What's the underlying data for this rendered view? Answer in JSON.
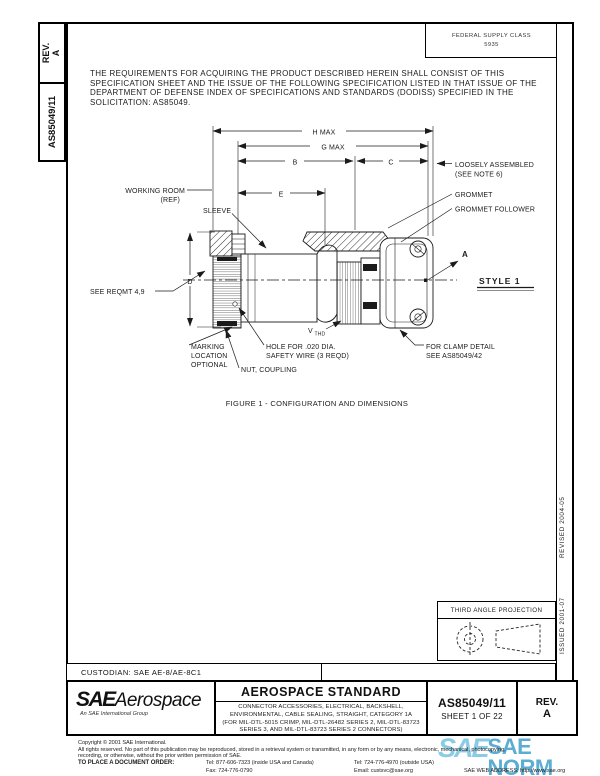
{
  "header": {
    "fsc_line1": "FEDERAL SUPPLY CLASS",
    "fsc_line2": "5935"
  },
  "sidebar": {
    "rev_label": "REV.",
    "rev_value": "A",
    "doc": "AS85049/11"
  },
  "right_margin": {
    "issued": "ISSUED 2001-07",
    "revised": "REVISED 2004-05"
  },
  "intro": {
    "lines": [
      "THE REQUIREMENTS FOR ACQUIRING THE PRODUCT DESCRIBED HEREIN SHALL CONSIST OF THIS",
      "SPECIFICATION SHEET AND THE ISSUE OF THE FOLLOWING SPECIFICATION LISTED IN THAT ISSUE OF THE",
      "DEPARTMENT OF DEFENSE INDEX OF SPECIFICATIONS AND STANDARDS (DODISS) SPECIFIED IN THE",
      "SOLICITATION: AS85049."
    ]
  },
  "figure": {
    "caption": "FIGURE 1 - CONFIGURATION AND DIMENSIONS",
    "dims": {
      "h": "H MAX",
      "g": "G MAX",
      "b": "B",
      "c": "C",
      "e": "E",
      "d": "D"
    },
    "labels": {
      "working_room_1": "WORKING ROOM",
      "working_room_2": "(REF)",
      "sleeve": "SLEEVE",
      "loosely_1": "LOOSELY ASSEMBLED",
      "loosely_2": "(SEE NOTE 6)",
      "grommet": "GROMMET",
      "grommet_follower": "GROMMET FOLLOWER",
      "see_reqmt": "SEE REQMT 4,9",
      "marking_1": "MARKING",
      "marking_2": "LOCATION",
      "marking_3": "OPTIONAL",
      "hole_1": "HOLE FOR .020 DIA.",
      "hole_2": "SAFETY WIRE (3 REQD)",
      "nut": "NUT, COUPLING",
      "clamp_1": "FOR CLAMP DETAIL",
      "clamp_2": "SEE AS85049/42",
      "v": "V",
      "v_sub": "THD",
      "view_a": "A",
      "style": "STYLE 1"
    }
  },
  "projection": {
    "title": "THIRD ANGLE PROJECTION"
  },
  "custodian": {
    "text": "CUSTODIAN: SAE AE-8/AE-8C1"
  },
  "title_block": {
    "logo_sae": "SAE",
    "logo_aero": "Aerospace",
    "logo_sub": "An SAE International Group",
    "standard": "AEROSPACE STANDARD",
    "desc": [
      "CONNECTOR ACCESSORIES, ELECTRICAL, BACKSHELL,",
      "ENVIRONMENTAL, CABLE SEALING, STRAIGHT, CATEGORY 1A",
      "(FOR MIL-DTL-5015 CRIMP, MIL-DTL-26482 SERIES 2, MIL-DTL-83723",
      "SERIES 3, AND MIL-DTL-83723 SERIES 2 CONNECTORS)"
    ],
    "doc_number": "AS85049/11",
    "sheet": "SHEET 1 OF 22",
    "rev_label": "REV.",
    "rev_value": "A"
  },
  "footer": {
    "copyright": "Copyright © 2001 SAE International.",
    "rights_1": "All rights reserved. No part of this publication may be reproduced, stored in a retrieval system or transmitted, in any form or by any means, electronic, mechanical, photocopying,",
    "rights_2": "recording, or otherwise, without the prior written permission of SAE.",
    "order": "TO PLACE A DOCUMENT ORDER:",
    "tel_inside": "Tel: 877-606-7323 (inside USA and Canada)",
    "tel_outside": "Tel: 724-776-4970 (outside USA)",
    "fax": "Fax: 724-776-0790",
    "email": "Email: custsvc@sae.org",
    "web": "SAE WEB ADDRESS: http://www.sae.org"
  },
  "watermark": {
    "sae": "SAE",
    "norm": "SAE NORM",
    "sub": "INTERNATIONAL ————————————",
    "accent": "#4aa5cf"
  }
}
